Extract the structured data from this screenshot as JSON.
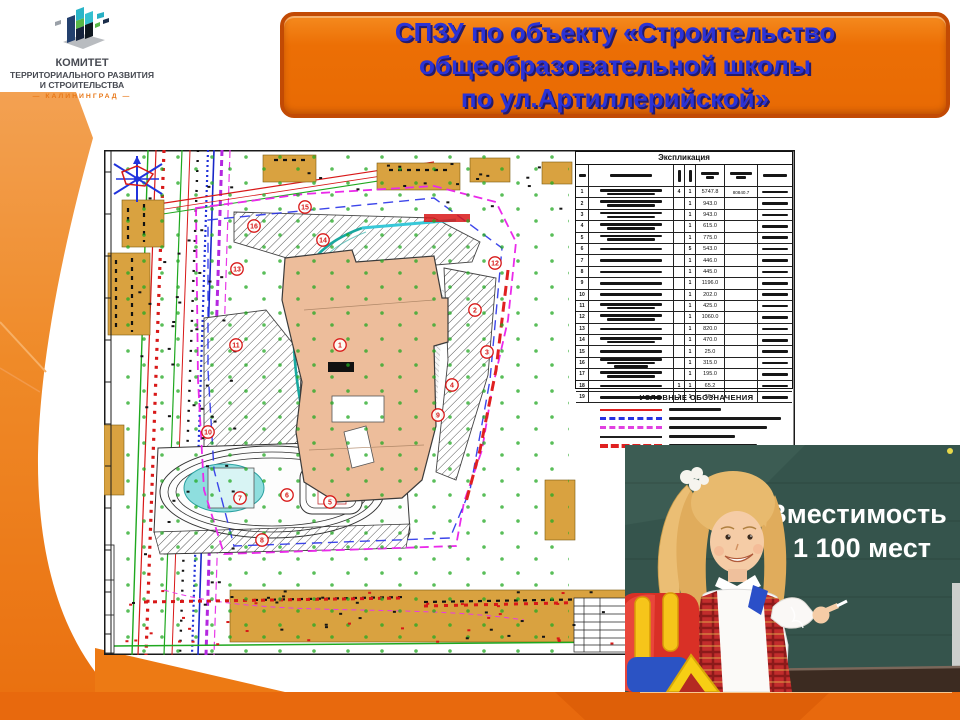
{
  "logo": {
    "line1": "КОМИТЕТ",
    "line2": "ТЕРРИТОРИАЛЬНОГО РАЗВИТИЯ",
    "line3": "И СТРОИТЕЛЬСТВА",
    "line4": "— КАЛИНИНГРАД —"
  },
  "banner": {
    "line1": "СПЗУ по объекту «Строительство",
    "line2": "общеобразовательной школы",
    "line3": "по ул.Артиллерийской»"
  },
  "plan": {
    "table": {
      "title": "Экспликация",
      "rows": [
        {
          "num": "1",
          "name_lines": 2,
          "q1": "4",
          "q2": "1",
          "area": "5747.8",
          "extra": "80840.7"
        },
        {
          "num": "2",
          "name_lines": 2,
          "q1": "",
          "q2": "1",
          "area": "943.0",
          "extra": ""
        },
        {
          "num": "3",
          "name_lines": 2,
          "q1": "",
          "q2": "1",
          "area": "943.0",
          "extra": ""
        },
        {
          "num": "4",
          "name_lines": 2,
          "q1": "",
          "q2": "1",
          "area": "615.0",
          "extra": ""
        },
        {
          "num": "5",
          "name_lines": 2,
          "q1": "",
          "q2": "1",
          "area": "775.0",
          "extra": ""
        },
        {
          "num": "6",
          "name_lines": 1,
          "q1": "",
          "q2": "5",
          "area": "543.0",
          "extra": ""
        },
        {
          "num": "7",
          "name_lines": 1,
          "q1": "",
          "q2": "1",
          "area": "446.0",
          "extra": ""
        },
        {
          "num": "8",
          "name_lines": 1,
          "q1": "",
          "q2": "1",
          "area": "445.0",
          "extra": ""
        },
        {
          "num": "9",
          "name_lines": 1,
          "q1": "",
          "q2": "1",
          "area": "1196.0",
          "extra": ""
        },
        {
          "num": "10",
          "name_lines": 1,
          "q1": "",
          "q2": "1",
          "area": "202.0",
          "extra": ""
        },
        {
          "num": "11",
          "name_lines": 2,
          "q1": "",
          "q2": "1",
          "area": "425.0",
          "extra": ""
        },
        {
          "num": "12",
          "name_lines": 2,
          "q1": "",
          "q2": "1",
          "area": "1060.0",
          "extra": ""
        },
        {
          "num": "13",
          "name_lines": 1,
          "q1": "",
          "q2": "1",
          "area": "820.0",
          "extra": ""
        },
        {
          "num": "14",
          "name_lines": 2,
          "q1": "",
          "q2": "1",
          "area": "470.0",
          "extra": ""
        },
        {
          "num": "15",
          "name_lines": 1,
          "q1": "",
          "q2": "1",
          "area": "25.0",
          "extra": ""
        },
        {
          "num": "16",
          "name_lines": 3,
          "q1": "",
          "q2": "1",
          "area": "315.0",
          "extra": ""
        },
        {
          "num": "17",
          "name_lines": 2,
          "q1": "",
          "q2": "1",
          "area": "195.0",
          "extra": ""
        },
        {
          "num": "18",
          "name_lines": 1,
          "q1": "1",
          "q2": "1",
          "area": "65.2",
          "extra": ""
        },
        {
          "num": "19",
          "name_lines": 1,
          "q1": "1",
          "q2": "1",
          "area": "30.0",
          "extra": ""
        }
      ]
    },
    "legend": {
      "title": "УСЛОВНЫЕ ОБОЗНАЧЕНИЯ",
      "items": [
        {
          "color": "#e02020",
          "style": "solid",
          "weight": 2,
          "label_w": 52
        },
        {
          "color": "#2832e0",
          "style": "dashed",
          "weight": 3,
          "label_w": 112
        },
        {
          "color": "#e040e0",
          "style": "dashed",
          "weight": 3,
          "label_w": 98
        },
        {
          "color": "#202020",
          "style": "solid",
          "weight": 2,
          "label_w": 66
        },
        {
          "color": "#e02020",
          "style": "dashed",
          "weight": 4,
          "label_w": 88
        }
      ]
    },
    "markers": [
      {
        "n": "1",
        "x": 236,
        "y": 195
      },
      {
        "n": "2",
        "x": 371,
        "y": 160
      },
      {
        "n": "3",
        "x": 383,
        "y": 202
      },
      {
        "n": "4",
        "x": 348,
        "y": 235
      },
      {
        "n": "5",
        "x": 226,
        "y": 352
      },
      {
        "n": "6",
        "x": 183,
        "y": 345
      },
      {
        "n": "7",
        "x": 136,
        "y": 348
      },
      {
        "n": "8",
        "x": 158,
        "y": 390
      },
      {
        "n": "9",
        "x": 334,
        "y": 265
      },
      {
        "n": "10",
        "x": 104,
        "y": 282
      },
      {
        "n": "11",
        "x": 132,
        "y": 195
      },
      {
        "n": "12",
        "x": 391,
        "y": 113
      },
      {
        "n": "13",
        "x": 133,
        "y": 119
      },
      {
        "n": "14",
        "x": 219,
        "y": 90
      },
      {
        "n": "15",
        "x": 201,
        "y": 57
      },
      {
        "n": "16",
        "x": 150,
        "y": 76
      }
    ]
  },
  "photo": {
    "caption_line1": "Вместимость",
    "caption_line2": "1 100 мест"
  },
  "colors": {
    "accent_orange": "#ee7008",
    "deep_orange": "#e8690d",
    "banner_border": "#c24a04",
    "banner_text": "#2b33d6",
    "board_green": "#35544c",
    "tan": "#d9a240",
    "building_fill": "#edbd9b"
  }
}
